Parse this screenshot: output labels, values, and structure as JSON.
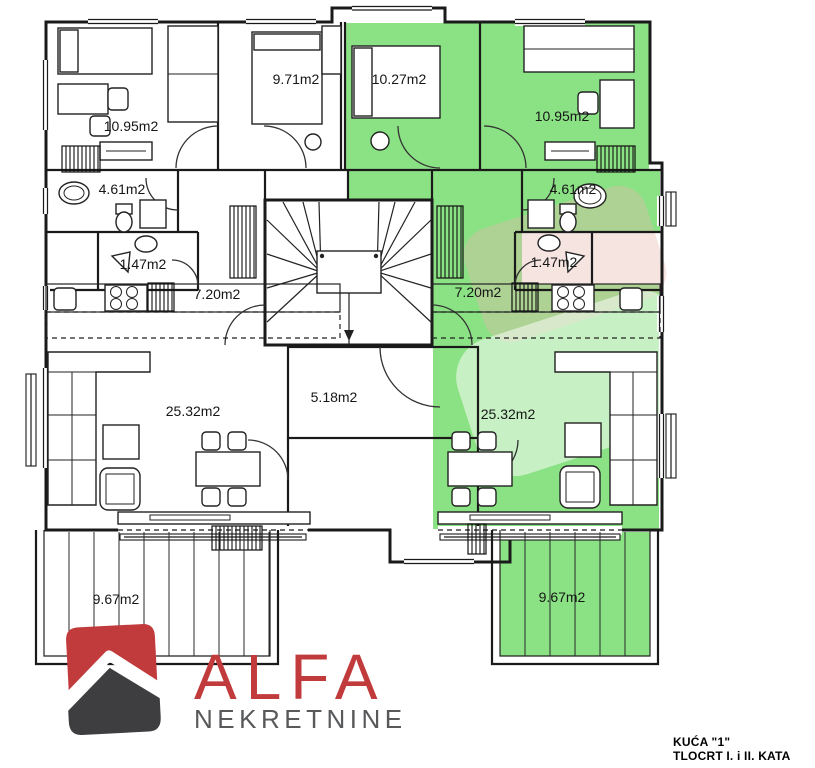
{
  "colors": {
    "highlight": "#8BE284",
    "wall": "#1a1a1a",
    "watermark_pink": "#E5B9AE",
    "watermark_light": "#FFFFFF",
    "logo_red": "#C23B3C",
    "logo_dark": "#3E3D40",
    "logo_subtitle_gray": "#58595B"
  },
  "branding": {
    "logo_title": "ALFA",
    "logo_subtitle": "NEKRETNINE"
  },
  "title_block": {
    "house": "KUĆA \"1\"",
    "floor": "TLOCRT I. i II. KATA"
  },
  "highlighted_apartment": "right",
  "apartments": [
    {
      "id": "left",
      "highlighted": false,
      "rooms": [
        {
          "type": "bedroom",
          "area": "10.95m2"
        },
        {
          "type": "bedroom",
          "area": "9.71m2"
        },
        {
          "type": "bathroom",
          "area": "4.61m2"
        },
        {
          "type": "toilet",
          "area": "1.47m2"
        },
        {
          "type": "hallway",
          "area": "7.20m2"
        },
        {
          "type": "living-dining-kitchen",
          "area": "25.32m2"
        },
        {
          "type": "terrace",
          "area": "9.67m2"
        }
      ]
    },
    {
      "id": "right",
      "highlighted": true,
      "rooms": [
        {
          "type": "bedroom",
          "area": "10.27m2"
        },
        {
          "type": "bedroom",
          "area": "10.95m2"
        },
        {
          "type": "bathroom",
          "area": "4.61m2"
        },
        {
          "type": "toilet",
          "area": "1.47m2"
        },
        {
          "type": "hallway",
          "area": "7.20m2"
        },
        {
          "type": "living-dining-kitchen",
          "area": "25.32m2"
        },
        {
          "type": "terrace",
          "area": "9.67m2"
        }
      ]
    }
  ],
  "common_areas": {
    "stairwell_entry": {
      "type": "entry",
      "area": "5.18m2"
    }
  }
}
